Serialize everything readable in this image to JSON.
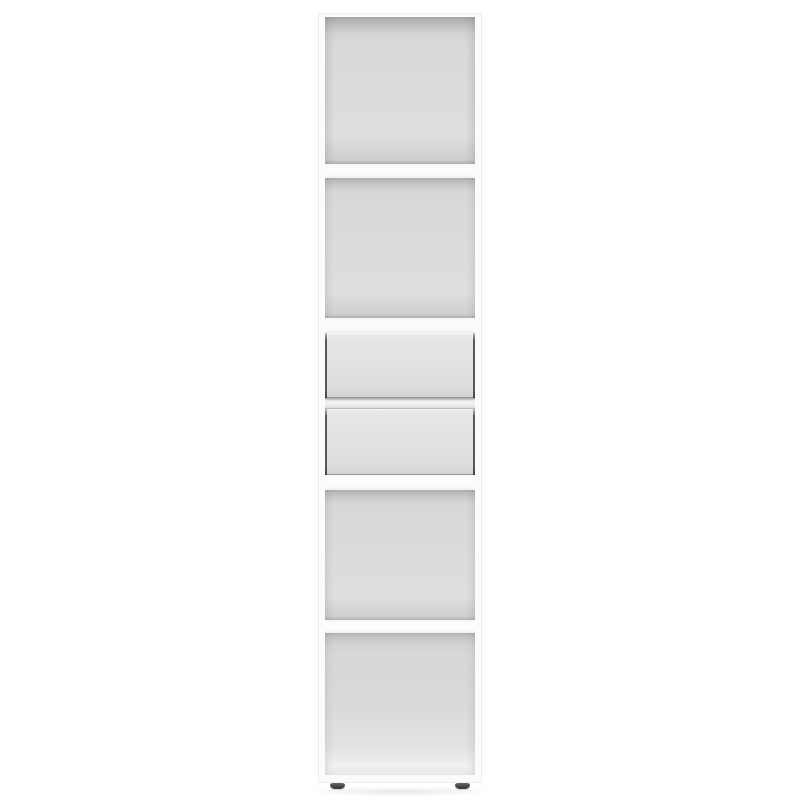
{
  "scene": {
    "type": "product-photo",
    "subject": "tall narrow white bookcase with two drawers, front view, centered on white background",
    "background_color": "#ffffff",
    "visible_text": []
  },
  "bookcase": {
    "finish": "white",
    "open_compartments": 4,
    "drawers": 2,
    "shelf_boards": 4,
    "feet_visible": 2,
    "compartments_top_to_bottom": [
      "open-compartment",
      "open-compartment",
      "drawer",
      "drawer",
      "open-compartment",
      "open-compartment"
    ]
  },
  "colors": {
    "canvas": "#ffffff",
    "frame": "#fbfbfb",
    "frame_edge": "#ececec",
    "cavity_light": "#dedede",
    "cavity_mid": "#d8d8d8",
    "cavity_dark": "#c6c6c6",
    "cavity_line": "#b5b5b5",
    "shelf_face": "#fcfcfc",
    "drawer_face": "#e1e1e1",
    "drawer_face_light": "#ececec",
    "drawer_gap": "#575757",
    "divider_light": "#f3f3f3",
    "foot": "#4f4f4f",
    "ground_shadow": "rgba(0,0,0,0.10)"
  }
}
